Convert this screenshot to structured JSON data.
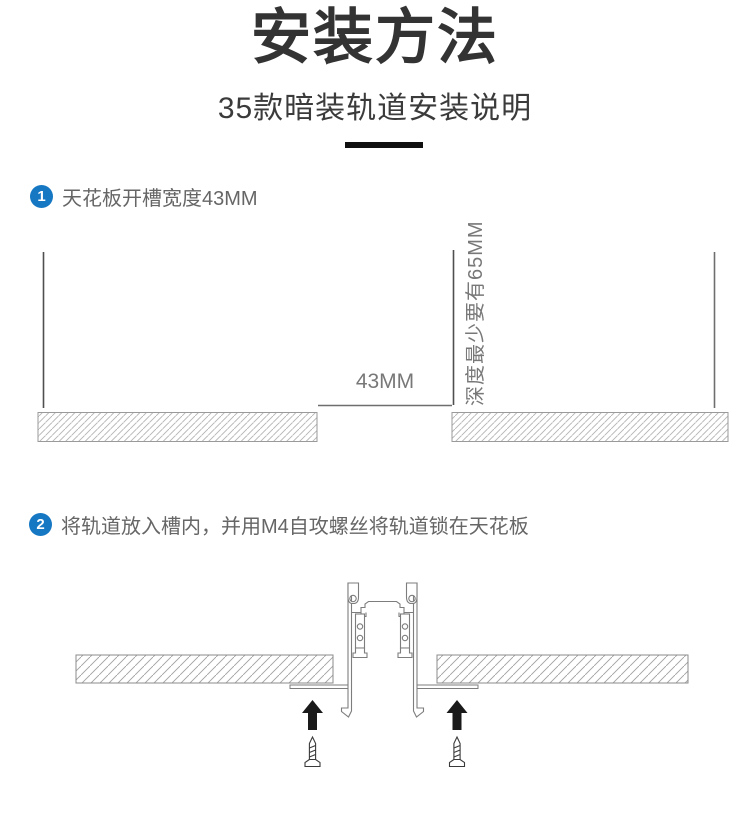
{
  "header": {
    "title": "安装方法",
    "subtitle": "35款暗装轨道安装说明"
  },
  "steps": [
    {
      "number": "1",
      "text": "天花板开槽宽度43MM"
    },
    {
      "number": "2",
      "text": "将轨道放入槽内，并用M4自攻螺丝将轨道锁在天花板"
    }
  ],
  "diagram1": {
    "slot_width_label": "43MM",
    "depth_label": "深度最少要有65MM"
  },
  "colors": {
    "accent_blue": "#1677c3",
    "title_text": "#333333",
    "step_text": "#666666",
    "dimension_text": "#787878",
    "dimension_line": "#555555",
    "hatch_border": "#999999",
    "track_outline": "#7d7d7d",
    "arrow_black": "#1a1a1a",
    "divider_black": "#101010"
  },
  "icons": {
    "step_badges": "numbered-circle",
    "arrows": "up-arrow",
    "screws": "self-tapping-screw"
  }
}
